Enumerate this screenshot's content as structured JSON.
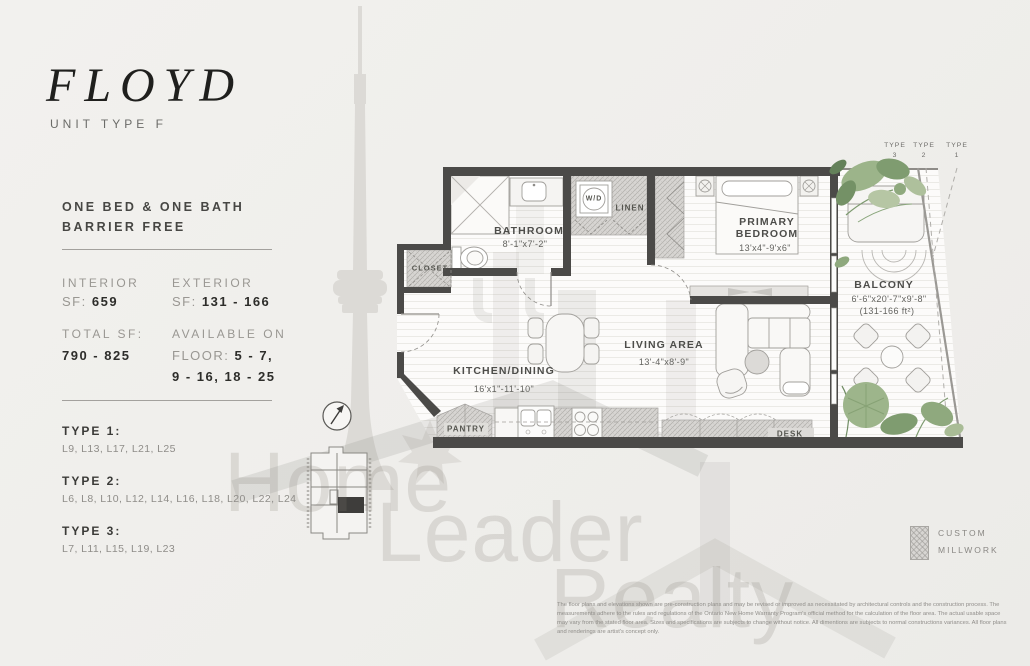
{
  "panel": {
    "title": "FLOYD",
    "subtitle": "UNIT TYPE F",
    "features": [
      "ONE BED & ONE BATH",
      "BARRIER FREE"
    ],
    "stats": {
      "interior_label": "INTERIOR",
      "sf_prefix": "SF:",
      "interior_value": "659",
      "exterior_label": "EXTERIOR",
      "exterior_value": "131 - 166",
      "total_label": "TOTAL SF:",
      "total_value": "790 - 825",
      "available_label": "AVAILABLE ON",
      "floor_prefix": "FLOOR:",
      "floor_value1": "5 - 7,",
      "floor_value2": "9 - 16, 18 - 25"
    },
    "types": [
      {
        "label": "TYPE 1:",
        "levels": "L9, L13, L17, L21, L25"
      },
      {
        "label": "TYPE 2:",
        "levels": "L6, L8, L10, L12, L14, L16, L18, L20, L22, L24"
      },
      {
        "label": "TYPE 3:",
        "levels": "L7, L11, L15, L19, L23"
      }
    ]
  },
  "plan": {
    "rooms": {
      "bathroom_name": "BATHROOM",
      "bathroom_dims": "8'-1\"x7'-2\"",
      "closet": "CLOSET",
      "wd": "W/D",
      "linen": "LINEN",
      "kitchen_name": "KITCHEN/DINING",
      "kitchen_dims": "16'x1\"-11'-10\"",
      "living_name": "LIVING AREA",
      "living_dims": "13'-4\"x8'-9\"",
      "bedroom_name1": "PRIMARY",
      "bedroom_name2": "BEDROOM",
      "bedroom_dims": "13'x4\"-9'x6\"",
      "balcony_name": "BALCONY",
      "balcony_dims": "6'-6\"x20'-7\"x9'-8\"",
      "balcony_area": "(131-166 ft²)",
      "pantry": "PANTRY",
      "desk": "DESK"
    },
    "type_markers": [
      {
        "t": "TYPE",
        "n": "3"
      },
      {
        "t": "TYPE",
        "n": "2"
      },
      {
        "t": "TYPE",
        "n": "1"
      }
    ]
  },
  "legend": {
    "line1": "CUSTOM",
    "line2": "MILLWORK"
  },
  "watermark": {
    "word1": "Home",
    "word2": "Leader",
    "word3": "Realty"
  },
  "disclaimer": "The floor plans and elevations shown are pre-construction plans and may be revised or improved as necessitated by architectural controls and the construction process. The measurements adhere to the rules and regulations of the Ontario New Home Warranty Program's official method for the calculation of the floor area.  The actual usable space may vary from the stated floor area. Sizes and specifications are subjects to change without notice. All dimentions are subjects to normal constructions variances. All floor plans and renderings are artist's concept only."
}
